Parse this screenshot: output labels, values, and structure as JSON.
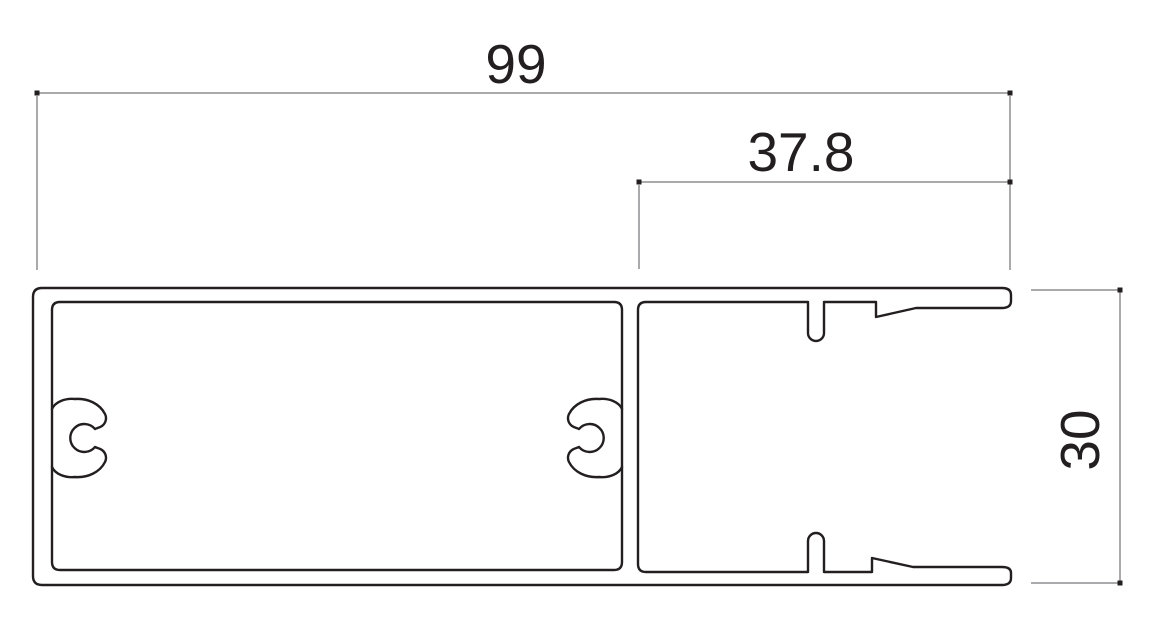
{
  "canvas": {
    "background_color": "#ffffff"
  },
  "drawing": {
    "description": "aluminum-extrusion-profile-cross-section",
    "profile_line_color": "#231f20",
    "dimension_line_color": "#77777a",
    "tick_color": "#231f20",
    "text_color": "#231f20",
    "dimensions": {
      "overall_width": {
        "label": "99",
        "orientation": "horizontal"
      },
      "channel_width": {
        "label": "37.8",
        "orientation": "horizontal"
      },
      "overall_height": {
        "label": "30",
        "orientation": "vertical"
      }
    }
  }
}
